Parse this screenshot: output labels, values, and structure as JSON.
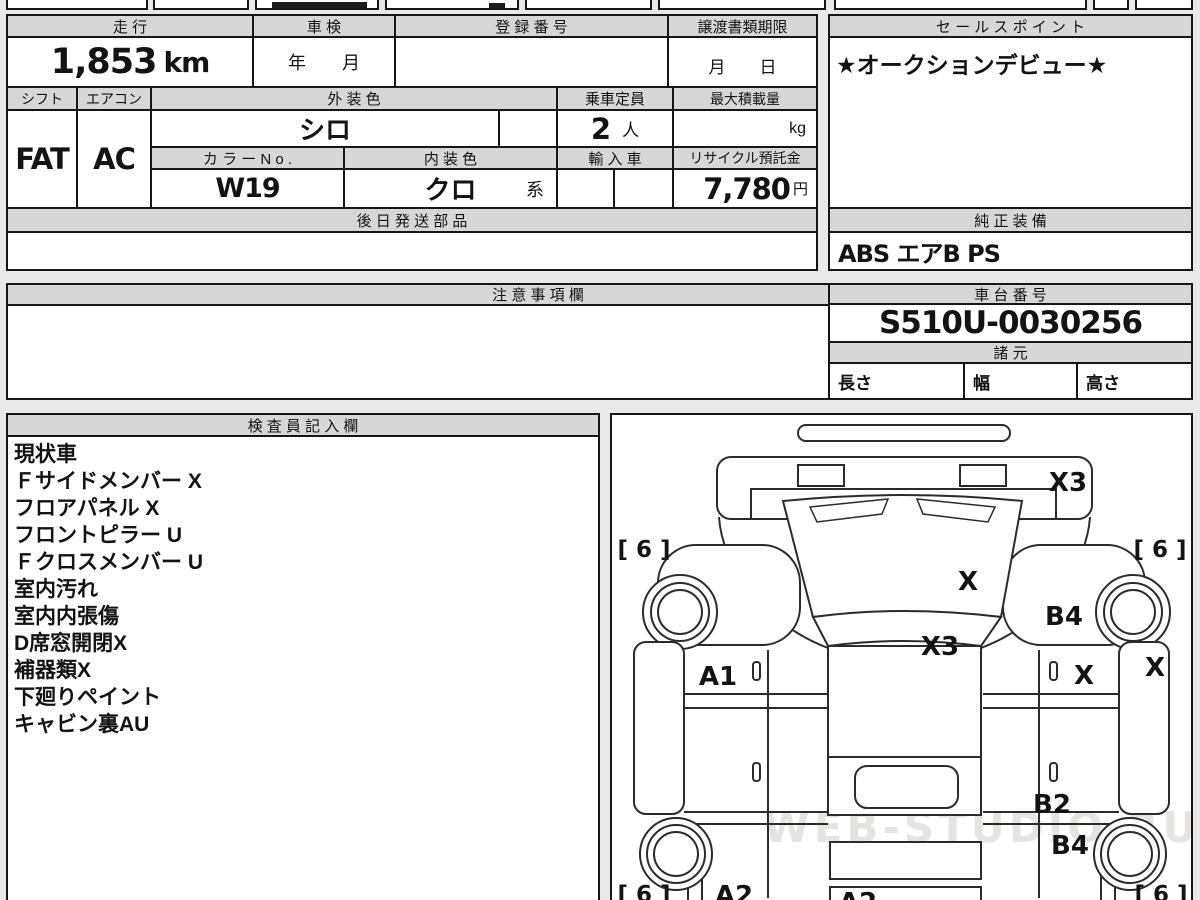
{
  "top_table": {
    "mileage_label": "走 行",
    "mileage_value": "1,853",
    "mileage_unit": "km",
    "shaken_label": "車 検",
    "shaken_value": "年　　月",
    "registration_label": "登 録 番 号",
    "transfer_docs_label": "譲渡書類期限",
    "transfer_docs_value": "月　　日",
    "shift_label": "シフト",
    "shift_value": "FAT",
    "aircon_label": "エアコン",
    "aircon_value": "AC",
    "exterior_color_label": "外 装 色",
    "exterior_color_value": "シロ",
    "capacity_label": "乗車定員",
    "capacity_value": "2",
    "capacity_unit": "人",
    "max_load_label": "最大積載量",
    "max_load_unit": "kg",
    "color_no_label": "カ ラ ー N o .",
    "color_no_value": "W19",
    "interior_color_label": "内 装 色",
    "interior_color_value": "クロ",
    "interior_color_suffix": "系",
    "import_label": "輸 入 車",
    "recycle_label": "リサイクル預託金",
    "recycle_value": "7,780",
    "recycle_unit": "円",
    "later_parts_label": "後 日 発 送 部 品"
  },
  "sales_point": {
    "label": "セ ー ル ス ポ イ ン ト",
    "value": "★オークションデビュー★"
  },
  "equipment": {
    "label": "純 正 装 備",
    "value": "ABS エアB PS"
  },
  "caution": {
    "label": "注 意 事 項 欄"
  },
  "chassis": {
    "label": "車 台 番 号",
    "value": "S510U-0030256",
    "specs_label": "諸 元",
    "length_label": "長さ",
    "width_label": "幅",
    "height_label": "高さ"
  },
  "inspector": {
    "label": "検 査 員 記 入 欄",
    "notes": [
      "現状車",
      "Ｆサイドメンバー X",
      "フロアパネル X",
      "フロントピラー U",
      "Ｆクロスメンバー U",
      "室内汚れ",
      "室内内張傷",
      "D席窓開閉X",
      "補器類X",
      "下廻りペイント",
      "キャビン裏AU"
    ]
  },
  "diagram": {
    "labels": {
      "x3_front": "X3",
      "six_front_left": "[ 6 ]",
      "six_front_right": "[ 6 ]",
      "x_windshield": "X",
      "b4_front": "B4",
      "x3_cowl": "X3",
      "a1_left": "A1",
      "x_bed_right": "X",
      "x_wall_right": "X",
      "b2_right": "B2",
      "b4_rear": "B4",
      "six_rear_left": "[ 6 ]",
      "six_rear_right": "[ 6 ]",
      "a2_left": "A2",
      "a2_center": "A2",
      "watermark": "WEB-STUDIO.RU"
    }
  }
}
